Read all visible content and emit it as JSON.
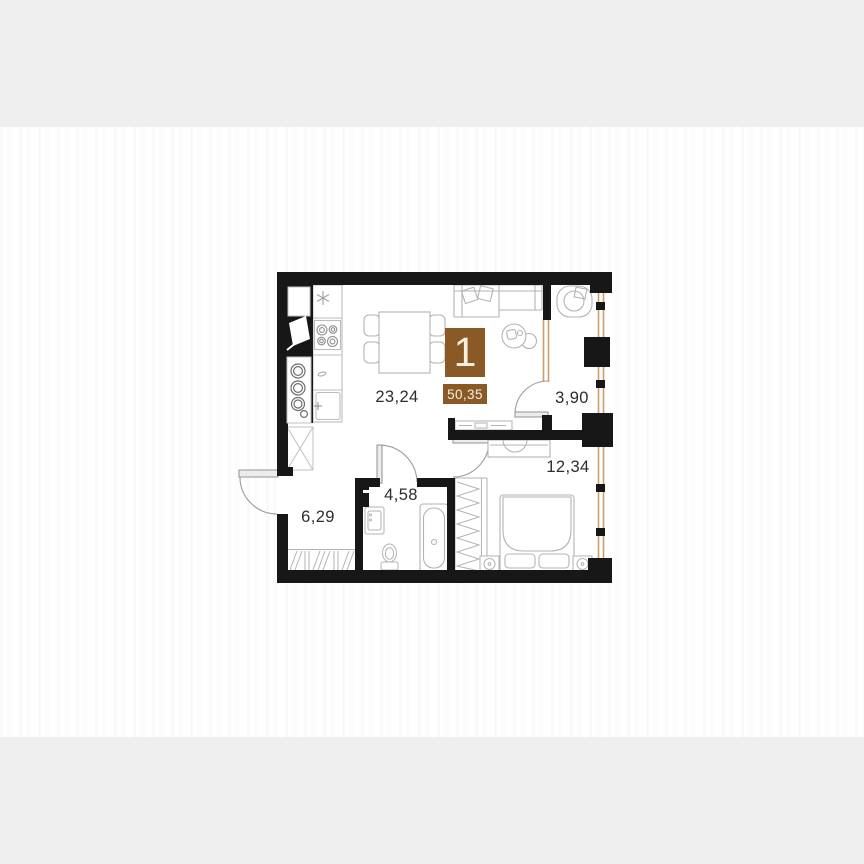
{
  "page": {
    "background_color": "#efefef",
    "panel_color": "#ffffff"
  },
  "floorplan": {
    "badge": {
      "rooms_count": "1",
      "total_area": "50,35",
      "background": "#8a5a26",
      "text_color": "#f5efdd"
    },
    "rooms": [
      {
        "id": "kitchen-living-room",
        "area_label": "23,24"
      },
      {
        "id": "balcony",
        "area_label": "3,90"
      },
      {
        "id": "bedroom",
        "area_label": "12,34"
      },
      {
        "id": "bathroom",
        "area_label": "4,58"
      },
      {
        "id": "hallway",
        "area_label": "6,29"
      }
    ],
    "colors": {
      "walls": "#171717",
      "windows": "#c9a06a",
      "furniture": "#b3b3b3",
      "label_text": "#2d2d2d"
    }
  }
}
